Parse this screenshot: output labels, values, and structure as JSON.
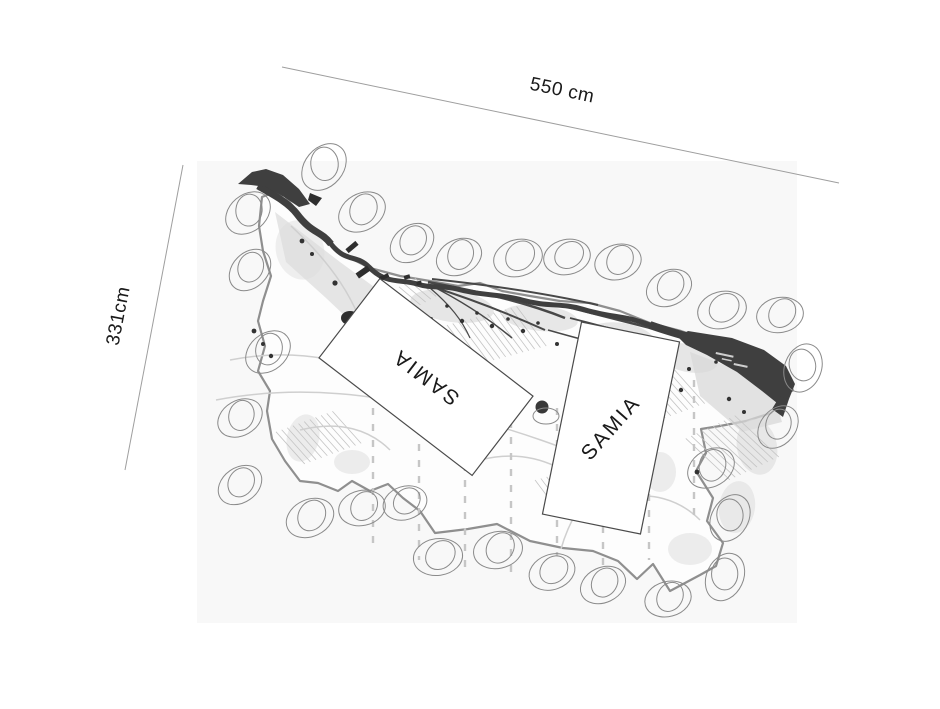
{
  "measurements": {
    "top_label": "550 cm",
    "left_label": "331cm"
  },
  "boxes": {
    "box1_label": "SAMIA",
    "box2_label": "SAMIA"
  },
  "colors": {
    "ink": "#1a1a1a",
    "dimension_line": "#9e9e9e",
    "river": "#3f3f3f",
    "stone_outline": "#8a8a8a",
    "boundary": "#8f8f8f"
  },
  "stones": [
    [
      324,
      167,
      -50,
      1.1
    ],
    [
      362,
      212,
      -30,
      1.05
    ],
    [
      412,
      243,
      -35,
      1.0
    ],
    [
      459,
      257,
      -25,
      1.0
    ],
    [
      518,
      258,
      -15,
      1.05
    ],
    [
      567,
      257,
      -12,
      1.0
    ],
    [
      618,
      262,
      -15,
      1.0
    ],
    [
      669,
      288,
      -25,
      1.0
    ],
    [
      722,
      310,
      -15,
      1.05
    ],
    [
      780,
      315,
      -10,
      1.0
    ],
    [
      803,
      368,
      -70,
      1.05
    ],
    [
      778,
      427,
      -50,
      1.0
    ],
    [
      711,
      468,
      -30,
      1.05
    ],
    [
      730,
      518,
      -60,
      1.05
    ],
    [
      725,
      577,
      -65,
      1.05
    ],
    [
      668,
      599,
      -15,
      1.0
    ],
    [
      603,
      585,
      -25,
      1.0
    ],
    [
      552,
      572,
      -20,
      1.0
    ],
    [
      498,
      550,
      -12,
      1.05
    ],
    [
      438,
      557,
      -8,
      1.05
    ],
    [
      405,
      503,
      -18,
      0.95
    ],
    [
      362,
      508,
      -12,
      1.0
    ],
    [
      310,
      518,
      -25,
      1.05
    ],
    [
      240,
      485,
      -35,
      1.0
    ],
    [
      240,
      418,
      -30,
      1.0
    ],
    [
      268,
      352,
      -40,
      1.05
    ],
    [
      250,
      270,
      -45,
      1.0
    ],
    [
      248,
      213,
      -40,
      1.05
    ]
  ]
}
